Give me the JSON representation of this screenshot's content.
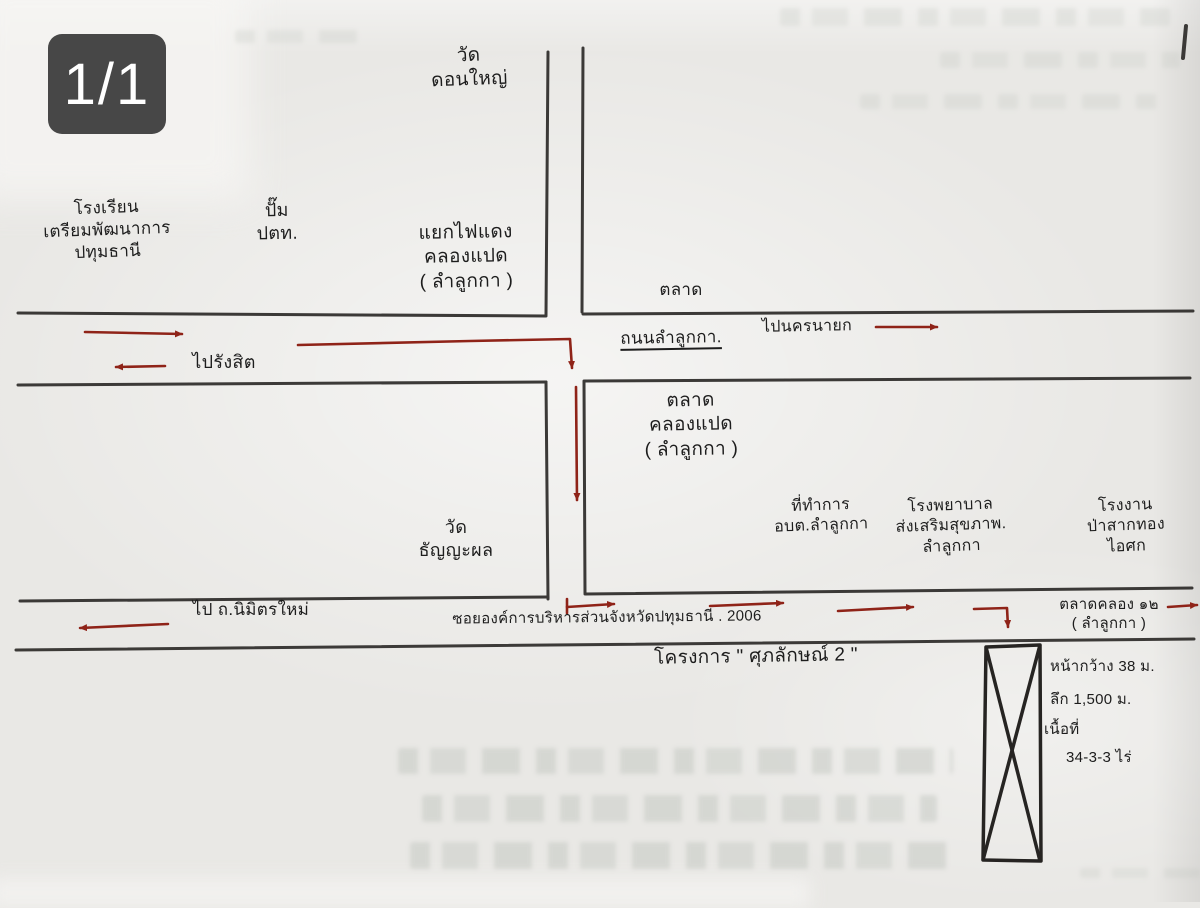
{
  "viewer": {
    "page_indicator": "1/1"
  },
  "colors": {
    "ink": "#1d1d1d",
    "road_line": "#2e2c2a",
    "arrow_red": "#8f2318",
    "badge_bg": "#474747",
    "badge_text": "#ffffff",
    "paper": "#e9e8e5"
  },
  "map": {
    "places": {
      "school": "โรงเรียน\nเตรียมพัฒนาการ\nปทุมธานี",
      "ptt_station": "ปั๊ม\nปตท.",
      "traffic_light_junction": "แยกไฟแดง\nคลองแปด\n( ลำลูกกา )",
      "wat_don_yai": "วัด\nดอนใหญ่",
      "market_top": "ตลาด",
      "market_khlong_paed": "ตลาด\nคลองแปด\n( ลำลูกกา )",
      "wat_thanyaphon": "วัด\nธัญญะผล",
      "sao_office": "ที่ทำการ\nอบต.ลำลูกกา",
      "health_hospital": "โรงพยาบาล\nส่งเสริมสุขภาพ.\nลำลูกกา",
      "factory": "โรงงาน\nป่าสากทอง\nไอศก",
      "market_khlong_12": "ตลาดคลอง ๑๒\n( ลำลูกกา )"
    },
    "roads": {
      "lam_luk_ka_road": "ถนนลำลูกกา.",
      "to_nakhon_nayok": "ไปนครนายก",
      "to_rangsit": "ไปรังสิต",
      "to_nimit_mai": "ไป ถ.นิมิตรใหม่",
      "soi_pao_pathum_thani": "ซอยองค์การบริหารส่วนจังหวัดปทุมธานี . 2006",
      "project_name": "โครงการ \" ศุภลักษณ์ 2 \""
    },
    "plot": {
      "frontage": "หน้ากว้าง 38 ม.",
      "depth": "ลึก 1,500 ม.",
      "area_label": "เนื้อที่",
      "area_value": "34-3-3 ไร่"
    }
  }
}
